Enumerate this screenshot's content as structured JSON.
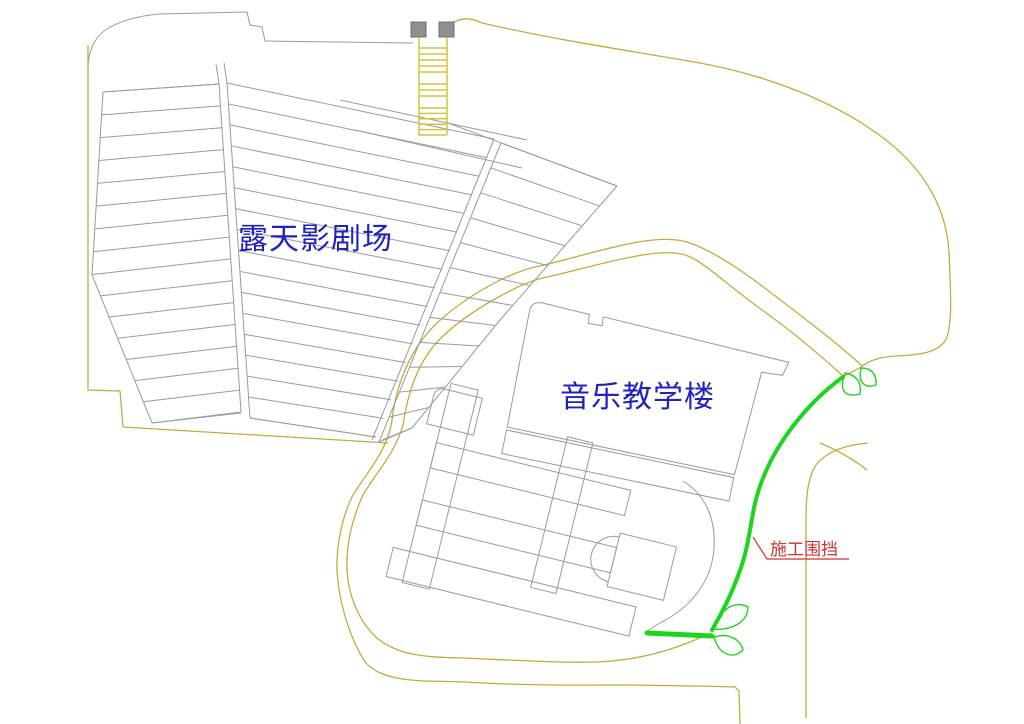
{
  "labels": {
    "theater_label": "露天影剧场",
    "music_building_label": "音乐教学楼",
    "fence_label": "施工围挡"
  },
  "colors": {
    "background": "#ffffff",
    "outline_gray": "#9a9aa0",
    "road_yellow": "#c9a93c",
    "stairs_yellow": "#d6c23e",
    "fence_green": "#1ed51e",
    "label_blue": "#2121bd",
    "annotation_red": "#cc3333",
    "square_gray": "#8f8f8f"
  },
  "legend": {
    "fence_symbol": "green-thick-line",
    "gate_symbol": "green-leaf-pair"
  }
}
